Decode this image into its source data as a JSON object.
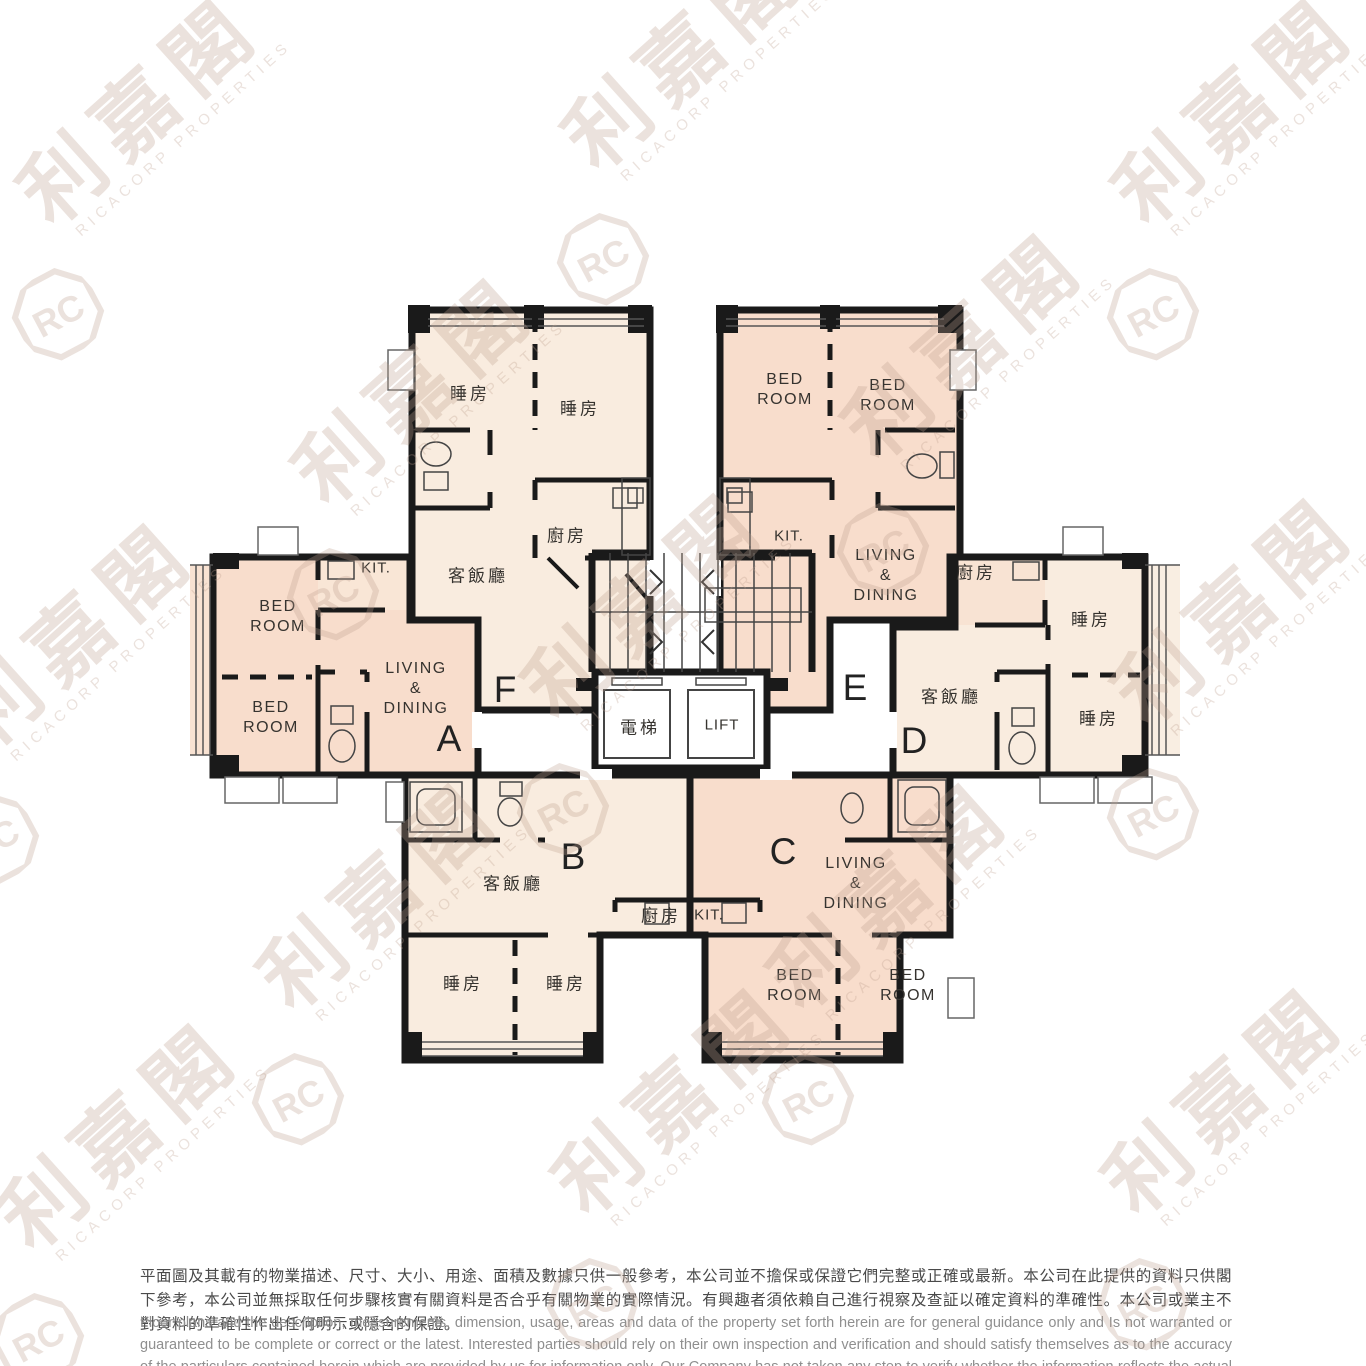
{
  "brand": {
    "logo_initials": "RC",
    "name_zh": "利嘉閣",
    "name_en": "RICACORP PROPERTIES"
  },
  "colors": {
    "wall": "#1a1a1a",
    "unit_cream": "#f9ecdf",
    "unit_pink": "#f8ddcc",
    "kitchen_light": "#f9e6d6",
    "disclaimer_zh_text": "#4a4a4a",
    "disclaimer_en_text": "#8f8f8f",
    "watermark": "#bca090"
  },
  "floorplan": {
    "units": [
      {
        "id": "A",
        "rooms": [
          "KIT.",
          "BED ROOM",
          "BED ROOM",
          "LIVING & DINING"
        ]
      },
      {
        "id": "B",
        "rooms": [
          "客飯廳",
          "廚房",
          "睡房",
          "睡房"
        ]
      },
      {
        "id": "C",
        "rooms": [
          "KIT.",
          "LIVING & DINING",
          "BED ROOM",
          "BED ROOM"
        ]
      },
      {
        "id": "D",
        "rooms": [
          "廚房",
          "客飯廳",
          "睡房",
          "睡房"
        ]
      },
      {
        "id": "E",
        "rooms": [
          "BED ROOM",
          "BED ROOM",
          "KIT.",
          "LIVING & DINING"
        ]
      },
      {
        "id": "F",
        "rooms": [
          "睡房",
          "睡房",
          "廚房",
          "客飯廳"
        ]
      }
    ],
    "labels": {
      "f_bed1": "睡房",
      "f_bed2": "睡房",
      "f_kitchen": "廚房",
      "f_living": "客飯廳",
      "f_letter": "F",
      "e_bed1": "BED\nROOM",
      "e_bed2": "BED\nROOM",
      "e_kit": "KIT.",
      "e_living": "LIVING\n&\nDINING",
      "e_letter": "E",
      "a_kit": "KIT.",
      "a_bed1": "BED\nROOM",
      "a_bed2": "BED\nROOM",
      "a_living": "LIVING\n&\nDINING",
      "a_letter": "A",
      "d_kitchen": "廚房",
      "d_bed1": "睡房",
      "d_bed2": "睡房",
      "d_living": "客飯廳",
      "d_letter": "D",
      "lift_zh": "電梯",
      "lift_en": "LIFT",
      "b_letter": "B",
      "b_living": "客飯廳",
      "b_kitchen": "廚房",
      "b_bed1": "睡房",
      "b_bed2": "睡房",
      "c_kit": "KIT.",
      "c_letter": "C",
      "c_living": "LIVING\n&\nDINING",
      "c_bed1": "BED\nROOM",
      "c_bed2": "BED\nROOM"
    }
  },
  "disclaimer": {
    "zh": "平面圖及其載有的物業描述、尺寸、大小、用途、面積及數據只供一般參考，本公司並不擔保或保證它們完整或正確或最新。本公司在此提供的資料只供閣下參考，本公司並無採取任何步驟核實有關資料是否合乎有關物業的實際情況。有興趣者須依賴自己進行視察及查証以確定資料的準確性。本公司或業主不對資料的準確性作出任何明示或隱含的保證。",
    "en": "Floor plans and the description, measurements, dimension, usage, areas and data of the property set forth herein are for general guidance only and Is not warranted or guaranteed to be complete or correct or the latest. Interested parties should rely on their own inspection and verification and should satisfy themselves as to the accuracy of the particulars contained herein which are provided by us for information only.  Our Company has not taken any step to verify whether the information reflects the actual status of the property.  No warranty for accuracy is given or implied by the owners or us."
  }
}
